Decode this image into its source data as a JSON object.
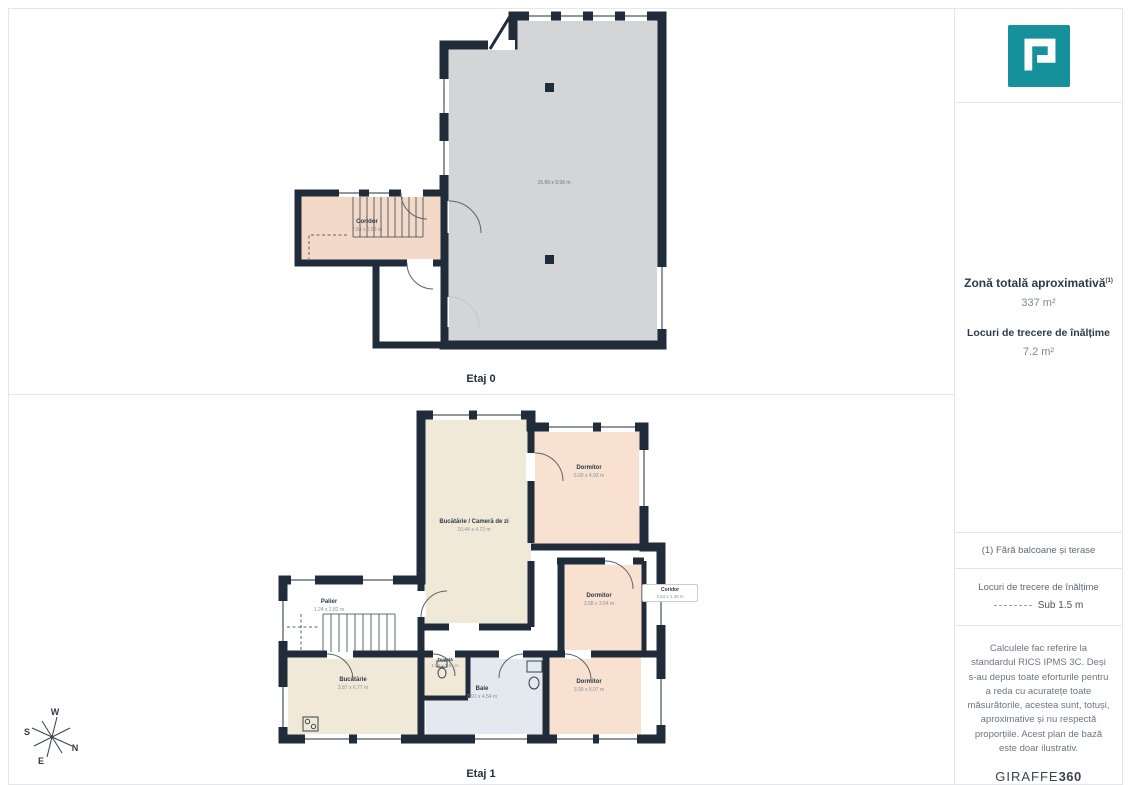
{
  "branding": {
    "logo_name": "giraffe360-floorplan-logo",
    "footer_brand": "GIRAFFE",
    "footer_brand_bold": "360"
  },
  "sidebar": {
    "total_area": {
      "title": "Zonă totală aproximativă",
      "superscript": "(1)",
      "value": "337 m²"
    },
    "passage": {
      "title": "Locuri de trecere de înălțime",
      "value": "7.2 m²"
    },
    "footnote": "(1) Fără balcoane și terase",
    "legend": {
      "title": "Locuri de trecere de înălțime",
      "value": "Sub 1.5 m"
    },
    "disclaimer": "Calculele fac referire la standardul RICS IPMS 3C. Deși s-au depus toate eforturile pentru a reda cu acuratețe toate măsurătorile, acestea sunt, totuși, aproximative și nu respectă proporțiile. Acest plan de bază este doar ilustrativ."
  },
  "plans": {
    "etaj0": {
      "label": "Etaj 0",
      "main_room_dims": "15.99 x 9.96 m",
      "rooms": [
        {
          "name": "Coridor",
          "dims": "2.84 x 6.68 m"
        }
      ]
    },
    "etaj1": {
      "label": "Etaj 1",
      "rooms": [
        {
          "name": "Bucătărie / Cameră de zi",
          "dims": "10.44 x 4.72 m"
        },
        {
          "name": "Dormitor",
          "dims": "5.00 x 4.93 m"
        },
        {
          "name": "Dormitor",
          "dims": "3.58 x 3.64 m"
        },
        {
          "name": "Coridor",
          "dims": "3.54 x 1.40 m"
        },
        {
          "name": "Dormitor",
          "dims": "3.99 x 5.07 m"
        },
        {
          "name": "Baie",
          "dims": "3.91 x 4.54 m"
        },
        {
          "name": "Toaletă",
          "dims": "1.64 x 1.55 m"
        },
        {
          "name": "Bucătărie",
          "dims": "3.87 x 6.77 m"
        },
        {
          "name": "Palier",
          "dims": "1.24 x 2.82 m"
        }
      ]
    }
  },
  "compass": {
    "n": "N",
    "s": "S",
    "e": "E",
    "w": "W"
  },
  "colors": {
    "wall": "#202c39",
    "room_gray": "#d3d5d7",
    "room_peach_light": "#f3d9c8",
    "room_peach": "#f8e1d1",
    "room_cream": "#f0e9d8",
    "room_blue": "#e4e8ef",
    "accent_teal": "#14919b"
  }
}
